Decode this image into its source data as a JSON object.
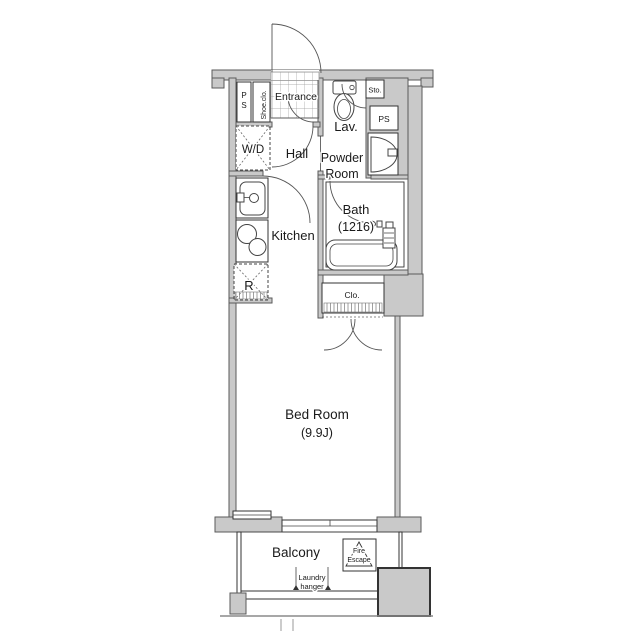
{
  "title": "apartment-floor-plan",
  "colors": {
    "wall_fill": "#c9c9c9",
    "wall_stroke": "#5a5a5a",
    "line": "#333333",
    "text": "#1a1a1a",
    "background": "#ffffff"
  },
  "rooms": {
    "entrance": {
      "label": "Entrance"
    },
    "ps_left": {
      "label": "PS"
    },
    "shoe_closet": {
      "label": "Shoe.clo."
    },
    "storage": {
      "label": "Sto."
    },
    "ps_right": {
      "label": "PS"
    },
    "lavatory": {
      "label": "Lav."
    },
    "powder_room": {
      "line1": "Powder",
      "line2": "Room"
    },
    "washer_dryer": {
      "label": "W/D"
    },
    "hall": {
      "label": "Hall"
    },
    "kitchen": {
      "label": "Kitchen"
    },
    "refrigerator": {
      "label": "R"
    },
    "bath": {
      "label": "Bath",
      "size": "(1216)"
    },
    "closet": {
      "label": "Clo."
    },
    "bedroom": {
      "label": "Bed Room",
      "size": "(9.9J)"
    },
    "balcony": {
      "label": "Balcony"
    },
    "fire_escape": {
      "line1": "Fire",
      "line2": "Escape"
    },
    "laundry_hanger": {
      "line1": "Laundry",
      "line2": "hanger"
    }
  }
}
